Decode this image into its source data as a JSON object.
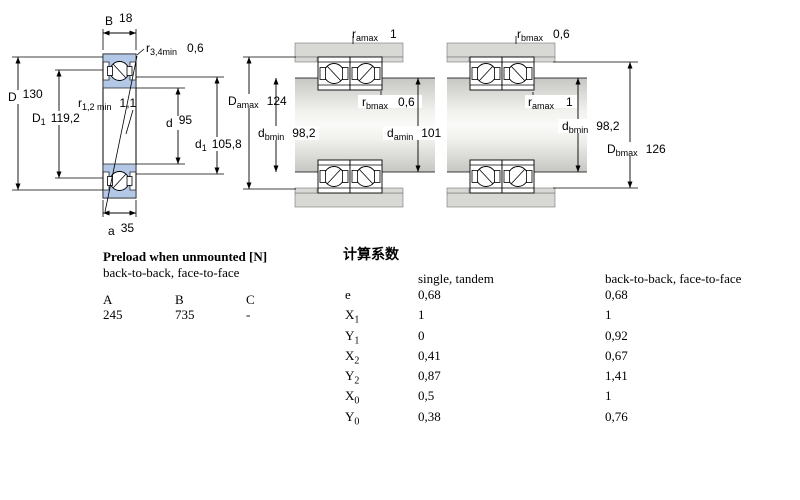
{
  "left": {
    "dims": {
      "B": {
        "main": "B",
        "sub": "",
        "value": "18"
      },
      "r34": {
        "main": "r",
        "sub": "3,4min",
        "value": "0,6"
      },
      "D": {
        "main": "D",
        "sub": "",
        "value": "130"
      },
      "D1": {
        "main": "D",
        "sub": "1",
        "value": "119,2"
      },
      "r12": {
        "main": "r",
        "sub": "1,2 min",
        "value": "1,1"
      },
      "d": {
        "main": "d",
        "sub": "",
        "value": "95"
      },
      "d1": {
        "main": "d",
        "sub": "1",
        "value": "105,8"
      },
      "a": {
        "main": "a",
        "sub": "",
        "value": "35"
      }
    }
  },
  "mid": {
    "dims": {
      "ramax": {
        "main": "r",
        "sub": "amax",
        "value": "1"
      },
      "Damax": {
        "main": "D",
        "sub": "amax",
        "value": "124"
      },
      "dbmin": {
        "main": "d",
        "sub": "bmin",
        "value": "98,2"
      },
      "rbmax": {
        "main": "r",
        "sub": "bmax",
        "value": "0,6"
      },
      "damin": {
        "main": "d",
        "sub": "amin",
        "value": "101"
      }
    }
  },
  "right": {
    "dims": {
      "rbmax": {
        "main": "r",
        "sub": "bmax",
        "value": "0,6"
      },
      "ramax": {
        "main": "r",
        "sub": "amax",
        "value": "1"
      },
      "dbmin": {
        "main": "d",
        "sub": "bmin",
        "value": "98,2"
      },
      "Dbmax": {
        "main": "D",
        "sub": "bmax",
        "value": "126"
      }
    }
  },
  "preload": {
    "title": "Preload when unmounted [N]",
    "subtitle": "back-to-back, face-to-face",
    "headers": [
      "A",
      "B",
      "C"
    ],
    "values": [
      "245",
      "735",
      "-"
    ]
  },
  "factors": {
    "title": "计算系数",
    "col_single": "single, tandem",
    "col_paired": "back-to-back, face-to-face",
    "rows": [
      {
        "label": "e",
        "sub": "",
        "single": "0,68",
        "paired": "0,68"
      },
      {
        "label": "X",
        "sub": "1",
        "single": "1",
        "paired": "1"
      },
      {
        "label": "Y",
        "sub": "1",
        "single": "0",
        "paired": "0,92"
      },
      {
        "label": "X",
        "sub": "2",
        "single": "0,41",
        "paired": "0,67"
      },
      {
        "label": "Y",
        "sub": "2",
        "single": "0,87",
        "paired": "1,41"
      },
      {
        "label": "X",
        "sub": "0",
        "single": "0,5",
        "paired": "1"
      },
      {
        "label": "Y",
        "sub": "0",
        "single": "0,38",
        "paired": "0,76"
      }
    ]
  },
  "colors": {
    "ring_blue": "#b3c7e6",
    "housing_grey": "#d8d8d4"
  }
}
